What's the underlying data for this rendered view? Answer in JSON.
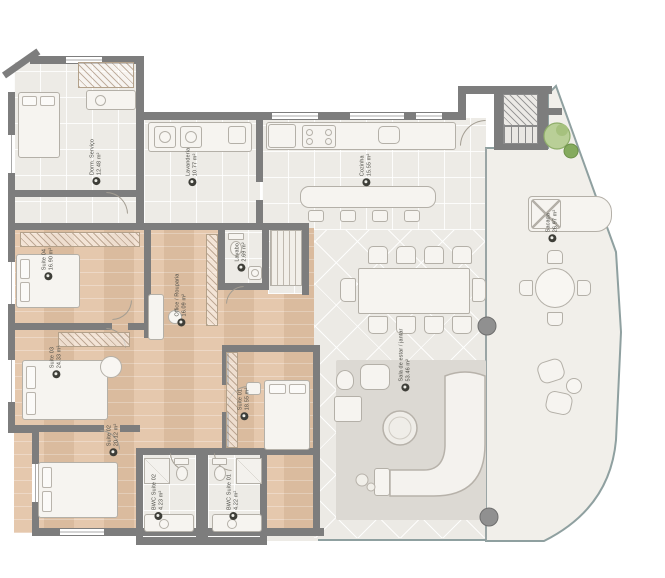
{
  "plan": {
    "type": "residential-apartment-floor-plan",
    "rooms": [
      {
        "id": "dorm-servico",
        "name": "Dorm. Serviço",
        "area": "12.48 m²"
      },
      {
        "id": "lavanderia",
        "name": "Lavanderia",
        "area": "10.77 m²"
      },
      {
        "id": "cozinha",
        "name": "Cozinha",
        "area": "15.55 m²"
      },
      {
        "id": "lavabo",
        "name": "Lavabo",
        "area": "2.69 m²"
      },
      {
        "id": "suite-04",
        "name": "Suíte 04",
        "area": "16.90 m²"
      },
      {
        "id": "office",
        "name": "Office / Rouparia",
        "area": "16.09 m²"
      },
      {
        "id": "suite-03",
        "name": "Suíte 03",
        "area": "24.33 m²"
      },
      {
        "id": "sala",
        "name": "Sala de estar / jantar",
        "area": "53.46 m²"
      },
      {
        "id": "suite-01",
        "name": "Suíte 01",
        "area": "18.55 m²"
      },
      {
        "id": "suite-02",
        "name": "Suíte 02",
        "area": "20.12 m²"
      },
      {
        "id": "bwc-suite-02",
        "name": "BWC Suíte 02",
        "area": "4.23 m²"
      },
      {
        "id": "bwc-suite-01",
        "name": "BWC Suíte 01",
        "area": "4.22 m²"
      },
      {
        "id": "sacada",
        "name": "Sacada",
        "area": "26.97 m²"
      }
    ],
    "icons": {
      "room_marker": "filled-circle-with-dot"
    },
    "colors": {
      "wall": "#7d7d7d",
      "wood_floor": "#e2c2a4",
      "tile_floor": "#edebe6",
      "balcony_floor": "#f1efea",
      "rug": "#dcd9d3",
      "marker": "#3e3e38",
      "plant": "#9cb874",
      "boundary": "#8fa0a0"
    }
  }
}
